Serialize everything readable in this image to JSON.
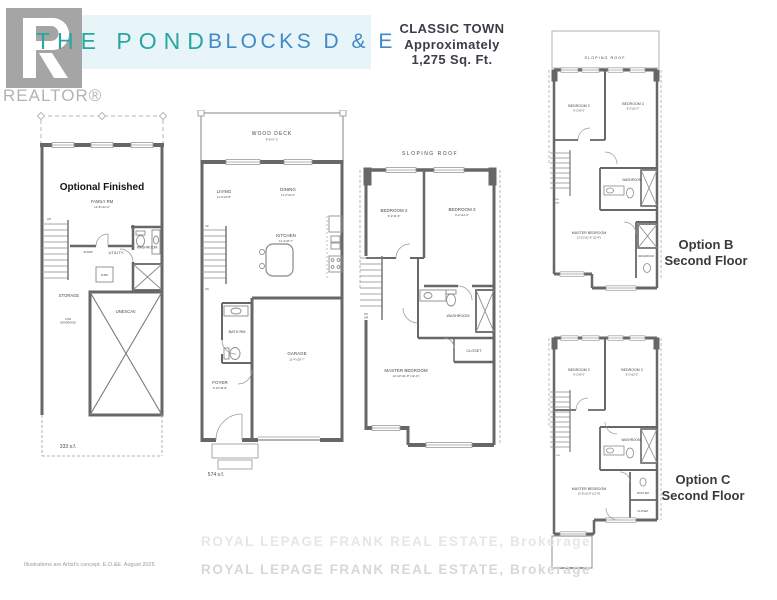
{
  "colors": {
    "band_bg": "#e7f4f8",
    "title_teal": "#2aa6a2",
    "subtitle_blue": "#4189c7",
    "model_text": "#3d3d48",
    "wall_gray": "#676767",
    "watermark_gray": "#dedede",
    "logo_gray": "#a5a5a5"
  },
  "header": {
    "logo_text": "REALTOR®",
    "title": "THE POND",
    "subtitle": "BLOCKS D & E",
    "type_name": "CLASSIC TOWN",
    "type_approx": "Approximately",
    "type_area": "1,275 Sq. Ft."
  },
  "basement": {
    "heading": "Optional Finished",
    "family_label": "FAMILY RM",
    "family_dims": "12'-8\"x12'-0\"",
    "up": "UP",
    "panel": "60 AMP",
    "utility": "UTILITY",
    "washroom": "WASHROOM",
    "furnace": "FURN",
    "storage": "STORAGE",
    "low_headroom_1": "LOW",
    "low_headroom_2": "HEADROOM",
    "unexcavated": "UNEXCAV.",
    "area": "333 s.f."
  },
  "main_floor": {
    "deck_label": "WOOD DECK",
    "deck_dims": "9'-0\"x7'-2\"",
    "living_label": "LIVING",
    "living_dims": "11'-0\"x9'-8\"",
    "dining_label": "DINING",
    "dining_dims": "11'-2\"x9'-2\"",
    "kitchen_label": "KITCHEN",
    "kitchen_dims": "11'-4\"x8'-7\"",
    "bath": "BATH RM",
    "garage_label": "GARAGE",
    "garage_dims": "11'-4\"x20'-7\"",
    "foyer_label": "FOYER",
    "foyer_dims": "5'-10\"x8'-8\"",
    "up": "UP",
    "dn": "DN",
    "area": "574 s.f."
  },
  "second_floor": {
    "roof": "SLOPING ROOF",
    "bedroom2_label": "BEDROOM 2",
    "bedroom2_dims": "9'-2\"x9'-6\"",
    "bedroom3_label": "BEDROOM 3",
    "bedroom3_dims": "9'-2\"x12'-2\"",
    "washroom": "WASHROOM",
    "closet": "CLOSET",
    "master_label": "MASTER BEDROOM",
    "master_dims": "12'-10\"x11'-8\" (12'-4\")",
    "dn": "DN",
    "stairs_note": "14R"
  },
  "option_b": {
    "caption_1": "Option B",
    "caption_2": "Second Floor",
    "roof": "SLOPING ROOF",
    "bedroom2_label": "BEDROOM 2",
    "bedroom2_dims": "9'-2\"x9'-6\"",
    "bedroom3_label": "BEDROOM 3",
    "bedroom3_dims": "9'-2\"x12'-2\"",
    "washroom": "WASHROOM",
    "ensuite": "WASHROOM",
    "master_label": "MASTER BEDROOM",
    "master_dims": "12'-10\"x11'-8\" (12'-4\")",
    "dn": "DN",
    "stairs_note": "14R"
  },
  "option_c": {
    "caption_1": "Option C",
    "caption_2": "Second Floor",
    "bedroom2_label": "BEDROOM 2",
    "bedroom2_dims": "9'-2\"x9'-6\"",
    "bedroom3_label": "BEDROOM 3",
    "bedroom3_dims": "9'-2\"x12'-2\"",
    "washroom": "WASHROOM",
    "bath": "BATH RM",
    "closet": "CLOSET",
    "master_label": "MASTER BEDROOM",
    "master_dims": "12'-8\"x11'-8\" (12'-4\")",
    "dn": "DN"
  },
  "footer": {
    "disclaimer": "Illustrations are Artist's concept. E.O.&E. August 2025",
    "watermark": "ROYAL LEPAGE FRANK REAL ESTATE, Brokerage"
  }
}
